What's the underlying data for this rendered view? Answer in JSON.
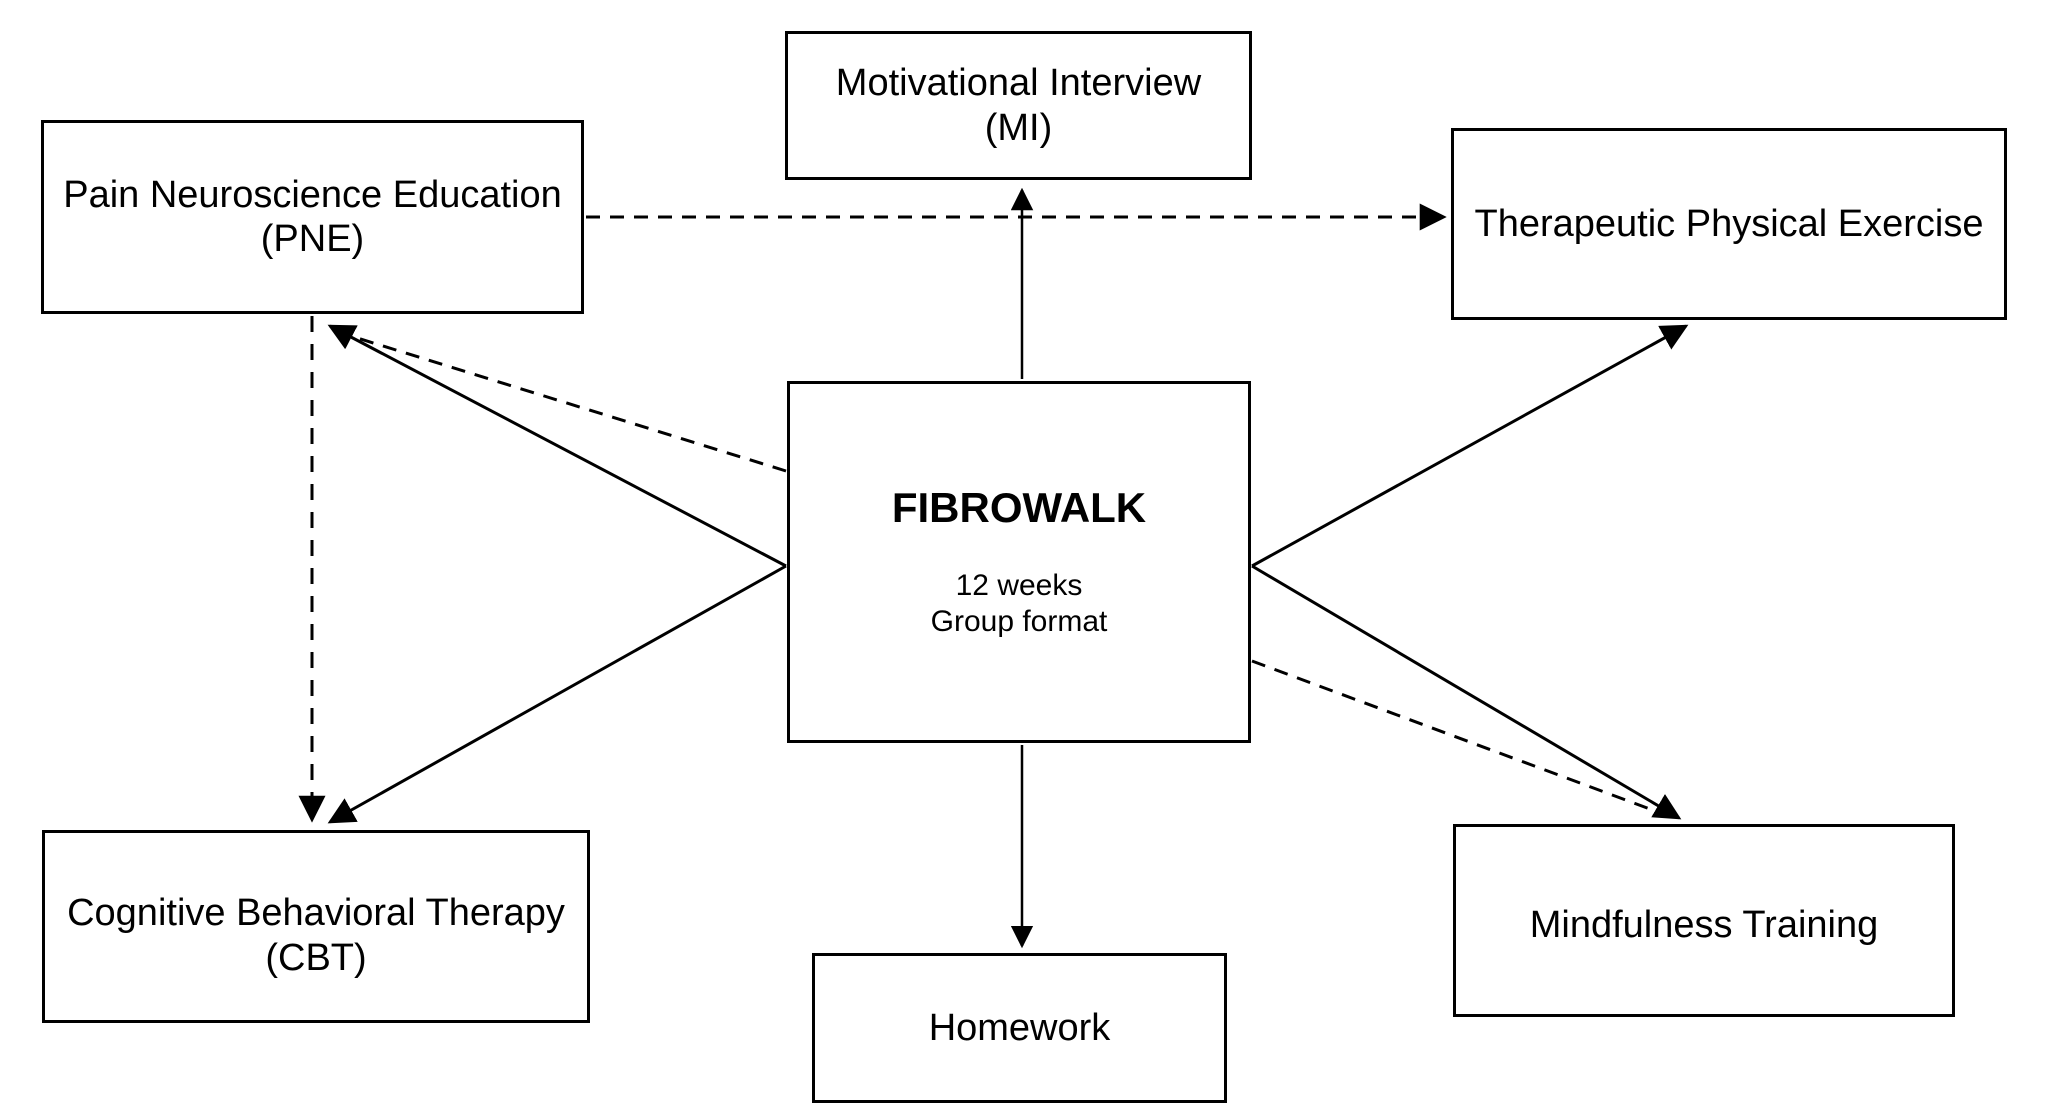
{
  "colors": {
    "line": "#000000",
    "text": "#000000",
    "box_fill": "#ffffff",
    "background": "#ffffff"
  },
  "nodes": {
    "motivational_interview": {
      "lines": [
        "Motivational Interview",
        "(MI)"
      ]
    },
    "pain_neuroscience_education": {
      "lines": [
        "Pain Neuroscience Education",
        "(PNE)"
      ]
    },
    "therapeutic_physical_exercise": {
      "lines": [
        "Therapeutic Physical Exercise"
      ]
    },
    "fibrowalk": {
      "title": "FIBROWALK",
      "details": [
        "12 weeks",
        "Group format"
      ]
    },
    "cognitive_behavioral_therapy": {
      "lines": [
        "Cognitive Behavioral Therapy",
        "(CBT)"
      ]
    },
    "mindfulness_training": {
      "lines": [
        "Mindfulness Training"
      ]
    },
    "homework": {
      "lines": [
        "Homework"
      ]
    }
  },
  "edges": [
    {
      "from": "FIBROWALK",
      "to": "Motivational Interview (MI)",
      "style": "solid",
      "arrowhead": "end"
    },
    {
      "from": "Pain Neuroscience Education (PNE)",
      "to": "Therapeutic Physical Exercise",
      "style": "dashed",
      "arrowhead": "end"
    },
    {
      "from": "FIBROWALK",
      "to": "Pain Neuroscience Education (PNE)",
      "style": "solid",
      "arrowhead": "end"
    },
    {
      "from": "FIBROWALK",
      "to": "Pain Neuroscience Education (PNE)",
      "style": "dashed",
      "arrowhead": "shared-end"
    },
    {
      "from": "Pain Neuroscience Education (PNE)",
      "to": "Cognitive Behavioral Therapy (CBT)",
      "style": "dashed",
      "arrowhead": "end"
    },
    {
      "from": "FIBROWALK",
      "to": "Cognitive Behavioral Therapy (CBT)",
      "style": "solid",
      "arrowhead": "end"
    },
    {
      "from": "FIBROWALK",
      "to": "Therapeutic Physical Exercise",
      "style": "solid",
      "arrowhead": "end"
    },
    {
      "from": "FIBROWALK",
      "to": "Mindfulness Training",
      "style": "solid",
      "arrowhead": "end"
    },
    {
      "from": "FIBROWALK",
      "to": "Mindfulness Training",
      "style": "dashed",
      "arrowhead": "shared-end"
    }
  ]
}
